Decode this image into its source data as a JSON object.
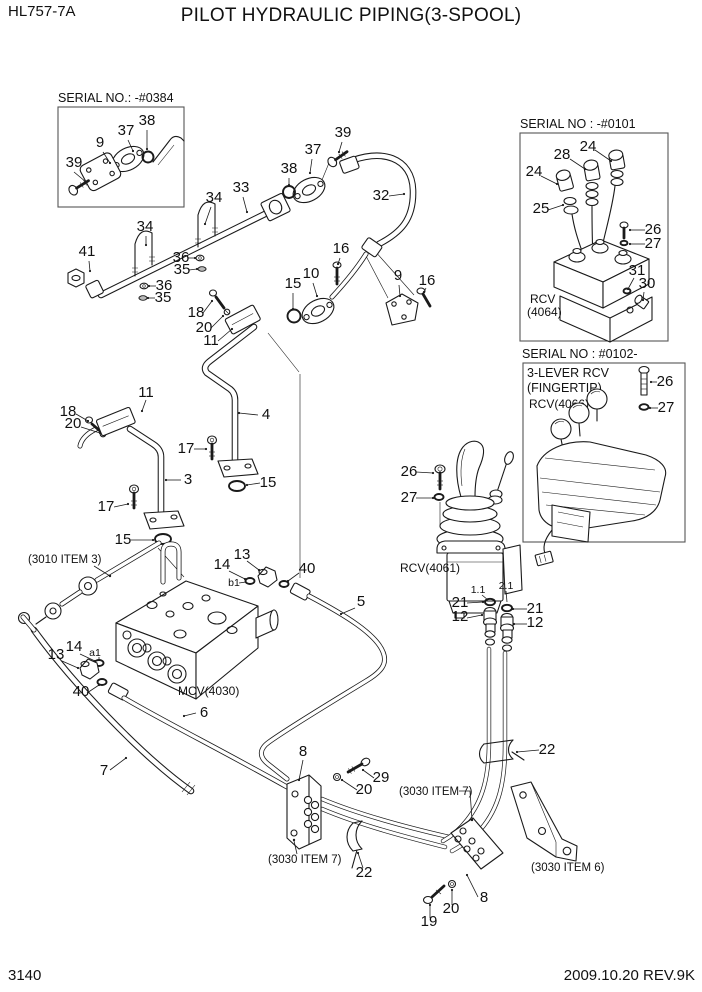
{
  "header": {
    "model": "HL757-7A",
    "title": "PILOT HYDRAULIC PIPING(3-SPOOL)"
  },
  "footer": {
    "page_number": "3140",
    "revision": "2009.10.20  REV.9K"
  },
  "colors": {
    "ink": "#1a1a1a",
    "paper": "#ffffff"
  },
  "insets": {
    "flange": {
      "serial": "SERIAL NO.: -#0384"
    },
    "rcv3lever": {
      "serial": "SERIAL NO : -#0101",
      "component_line1": "RCV",
      "component_line2": "(4064)"
    },
    "fingertip": {
      "serial": "SERIAL NO : #0102-",
      "title_line1": "3-LEVER RCV",
      "title_line2": "(FINGERTIP)",
      "component": "RCV(4066)"
    }
  },
  "components": {
    "mcv": "MCV(4030)",
    "rcv_joystick": "RCV(4061)"
  },
  "references": {
    "hose_item": "(3010 ITEM 3)",
    "clamp_item_left": "(3030 ITEM 7)",
    "clamp_item_right": "(3030 ITEM 7)",
    "bracket_item": "(3030 ITEM 6)"
  },
  "ports": {
    "a1": "a1",
    "b1": "b1",
    "port_1_1": "1.1",
    "port_2_1": "2.1"
  },
  "callouts": [
    {
      "n": "39",
      "x": 74,
      "y": 167,
      "l": [
        74,
        172,
        86,
        182
      ]
    },
    {
      "n": "9",
      "x": 100,
      "y": 147,
      "l": [
        103,
        152,
        110,
        163
      ]
    },
    {
      "n": "37",
      "x": 126,
      "y": 135,
      "l": [
        128,
        140,
        133,
        151
      ]
    },
    {
      "n": "38",
      "x": 147,
      "y": 125,
      "l": [
        147,
        130,
        147,
        149
      ]
    },
    {
      "n": "41",
      "x": 87,
      "y": 256,
      "l": [
        89,
        261,
        90,
        271
      ]
    },
    {
      "n": "34",
      "x": 145,
      "y": 231,
      "l": [
        146,
        236,
        146,
        245
      ]
    },
    {
      "n": "34",
      "x": 214,
      "y": 202,
      "l": [
        211,
        207,
        205,
        224
      ]
    },
    {
      "n": "33",
      "x": 241,
      "y": 192,
      "l": [
        243,
        197,
        247,
        212
      ]
    },
    {
      "n": "36",
      "x": 181,
      "y": 262,
      "l": [
        188,
        258,
        195,
        258
      ]
    },
    {
      "n": "35",
      "x": 182,
      "y": 274,
      "l": [
        189,
        270,
        197,
        269
      ]
    },
    {
      "n": "36",
      "x": 164,
      "y": 290,
      "l": [
        156,
        286,
        149,
        286
      ]
    },
    {
      "n": "35",
      "x": 163,
      "y": 302,
      "l": [
        155,
        298,
        148,
        298
      ]
    },
    {
      "n": "39",
      "x": 343,
      "y": 137,
      "l": [
        342,
        142,
        339,
        152
      ]
    },
    {
      "n": "37",
      "x": 313,
      "y": 154,
      "l": [
        312,
        159,
        310,
        173
      ]
    },
    {
      "n": "38",
      "x": 289,
      "y": 173,
      "l": [
        289,
        178,
        289,
        185
      ]
    },
    {
      "n": "32",
      "x": 381,
      "y": 200,
      "l": [
        389,
        196,
        404,
        194
      ]
    },
    {
      "n": "16",
      "x": 341,
      "y": 253,
      "l": [
        340,
        258,
        338,
        264
      ]
    },
    {
      "n": "10",
      "x": 311,
      "y": 278,
      "l": [
        313,
        283,
        317,
        296
      ]
    },
    {
      "n": "15",
      "x": 293,
      "y": 288,
      "l": [
        293,
        293,
        293,
        309
      ]
    },
    {
      "n": "9",
      "x": 398,
      "y": 280,
      "l": [
        399,
        285,
        400,
        296
      ]
    },
    {
      "n": "16",
      "x": 427,
      "y": 285,
      "l": [
        426,
        288,
        424,
        292
      ]
    },
    {
      "n": "18",
      "x": 196,
      "y": 317,
      "l": [
        203,
        313,
        212,
        301
      ]
    },
    {
      "n": "20",
      "x": 204,
      "y": 332,
      "l": [
        211,
        328,
        223,
        316
      ]
    },
    {
      "n": "11",
      "x": 211,
      "y": 345,
      "l": [
        218,
        341,
        232,
        329
      ]
    },
    {
      "n": "4",
      "x": 266,
      "y": 419,
      "l": [
        258,
        415,
        239,
        413
      ]
    },
    {
      "n": "17",
      "x": 186,
      "y": 453,
      "l": [
        194,
        449,
        206,
        449
      ]
    },
    {
      "n": "15",
      "x": 268,
      "y": 487,
      "l": [
        260,
        483,
        247,
        485
      ]
    },
    {
      "n": "18",
      "x": 68,
      "y": 416,
      "l": [
        76,
        414,
        88,
        421
      ]
    },
    {
      "n": "20",
      "x": 73,
      "y": 428,
      "l": [
        81,
        427,
        100,
        433
      ]
    },
    {
      "n": "11",
      "x": 146,
      "y": 397,
      "l": [
        146,
        400,
        142,
        411
      ]
    },
    {
      "n": "3",
      "x": 188,
      "y": 484,
      "l": [
        181,
        480,
        166,
        480
      ]
    },
    {
      "n": "17",
      "x": 106,
      "y": 511,
      "l": [
        114,
        507,
        128,
        504
      ]
    },
    {
      "n": "15",
      "x": 123,
      "y": 544,
      "l": [
        131,
        540,
        153,
        540
      ]
    },
    {
      "n": "13",
      "x": 242,
      "y": 559,
      "l": [
        247,
        561,
        259,
        570
      ]
    },
    {
      "n": "14",
      "x": 222,
      "y": 569,
      "l": [
        229,
        571,
        245,
        579
      ]
    },
    {
      "n": "40",
      "x": 307,
      "y": 573,
      "l": [
        299,
        573,
        288,
        581
      ]
    },
    {
      "n": "5",
      "x": 361,
      "y": 606,
      "l": [
        355,
        608,
        341,
        614
      ]
    },
    {
      "n": "13",
      "x": 56,
      "y": 659,
      "l": [
        62,
        661,
        78,
        668
      ]
    },
    {
      "n": "14",
      "x": 74,
      "y": 651,
      "l": [
        80,
        654,
        95,
        661
      ]
    },
    {
      "n": "40",
      "x": 81,
      "y": 696,
      "l": [
        87,
        693,
        99,
        685
      ]
    },
    {
      "n": "6",
      "x": 204,
      "y": 717,
      "l": [
        196,
        713,
        184,
        716
      ]
    },
    {
      "n": "7",
      "x": 104,
      "y": 775,
      "l": [
        110,
        770,
        126,
        758
      ]
    },
    {
      "n": "26",
      "x": 409,
      "y": 476,
      "l": [
        416,
        472,
        433,
        473
      ]
    },
    {
      "n": "27",
      "x": 409,
      "y": 502,
      "l": [
        416,
        498,
        433,
        498
      ]
    },
    {
      "n": "21",
      "x": 460,
      "y": 607,
      "l": [
        467,
        603,
        483,
        602
      ]
    },
    {
      "n": "12",
      "x": 460,
      "y": 621,
      "l": [
        467,
        618,
        482,
        615
      ]
    },
    {
      "n": "21",
      "x": 535,
      "y": 613,
      "l": [
        527,
        609,
        513,
        609
      ]
    },
    {
      "n": "12",
      "x": 535,
      "y": 627,
      "l": [
        527,
        624,
        514,
        624
      ]
    },
    {
      "n": "22",
      "x": 547,
      "y": 754,
      "l": [
        539,
        750,
        517,
        752
      ]
    },
    {
      "n": "8",
      "x": 303,
      "y": 756,
      "l": [
        303,
        760,
        299,
        780
      ]
    },
    {
      "n": "29",
      "x": 381,
      "y": 782,
      "l": [
        374,
        778,
        363,
        770
      ]
    },
    {
      "n": "20",
      "x": 364,
      "y": 794,
      "l": [
        357,
        790,
        342,
        780
      ]
    },
    {
      "n": "22",
      "x": 364,
      "y": 877,
      "l": [
        363,
        868,
        358,
        853
      ]
    },
    {
      "n": "8",
      "x": 484,
      "y": 902,
      "l": [
        478,
        897,
        467,
        875
      ]
    },
    {
      "n": "20",
      "x": 451,
      "y": 913,
      "l": [
        452,
        905,
        452,
        890
      ]
    },
    {
      "n": "19",
      "x": 429,
      "y": 926,
      "l": [
        430,
        918,
        430,
        905
      ]
    },
    {
      "n": "24",
      "x": 588,
      "y": 151,
      "l": [
        595,
        150,
        611,
        161
      ]
    },
    {
      "n": "28",
      "x": 562,
      "y": 159,
      "l": [
        570,
        159,
        585,
        169
      ]
    },
    {
      "n": "24",
      "x": 534,
      "y": 176,
      "l": [
        541,
        176,
        557,
        184
      ]
    },
    {
      "n": "25",
      "x": 541,
      "y": 213,
      "l": [
        548,
        210,
        563,
        205
      ]
    },
    {
      "n": "26",
      "x": 653,
      "y": 234,
      "l": [
        645,
        230,
        630,
        230
      ]
    },
    {
      "n": "27",
      "x": 653,
      "y": 248,
      "l": [
        645,
        244,
        630,
        244
      ]
    },
    {
      "n": "31",
      "x": 637,
      "y": 275,
      "l": [
        634,
        278,
        628,
        289
      ]
    },
    {
      "n": "30",
      "x": 647,
      "y": 288,
      "l": [
        644,
        292,
        643,
        300
      ]
    },
    {
      "n": "26",
      "x": 665,
      "y": 386,
      "l": [
        657,
        382,
        651,
        382
      ]
    },
    {
      "n": "27",
      "x": 666,
      "y": 412,
      "l": [
        658,
        408,
        650,
        408
      ]
    }
  ]
}
